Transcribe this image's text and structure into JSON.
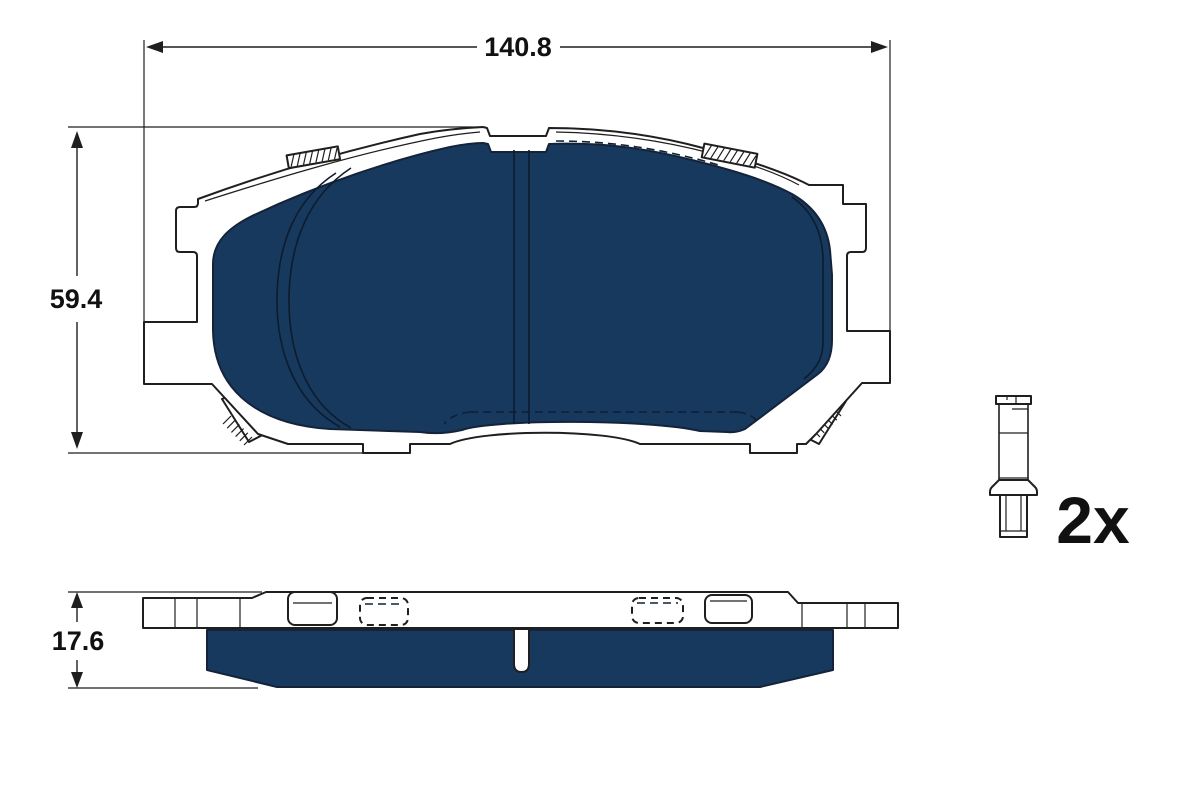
{
  "drawing": {
    "front_view": {
      "width_dim": "140.8",
      "height_dim": "59.4"
    },
    "side_view": {
      "thickness_dim": "17.6"
    },
    "accessory": {
      "quantity": "2x"
    },
    "colors": {
      "friction_material": "#17395E",
      "lines": "#1F1F1F",
      "background": "#FFFFFF"
    }
  }
}
